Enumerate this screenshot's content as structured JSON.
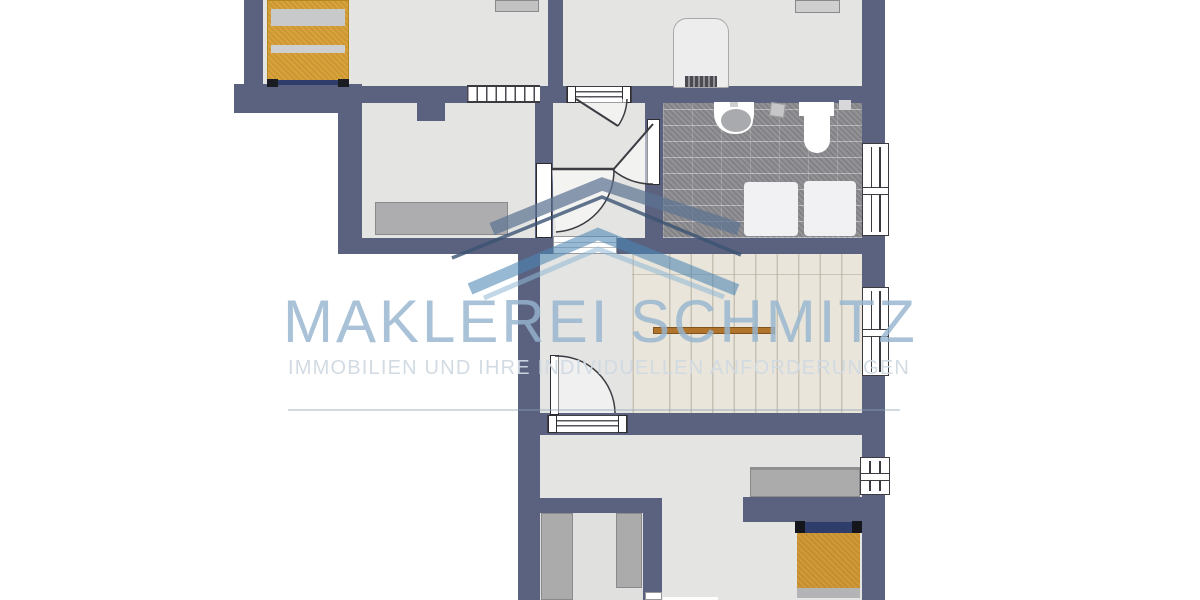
{
  "watermark": {
    "title": "MAKLEREI SCHMITZ",
    "subtitle": "IMMOBILIEN UND IHRE INDIVIDUELLEN ANFORDERUNGEN"
  },
  "palette": {
    "wall": "#5a6280",
    "floor": "#e4e4e3",
    "stair_floor": "#e9e5da",
    "tile": "#8d8d91",
    "bed_orange": "#d9a33c",
    "furniture_gray": "#ababab",
    "headboard_navy": "#2e3d69",
    "handrail_orange": "#b1742c",
    "wm_title": "rgba(150,181,208,0.82)",
    "wm_sub": "rgba(208,217,226,0.95)",
    "ribbon_slate": "#5d7392",
    "ribbon_navy": "#3b5372",
    "ribbon_steel": "#4e86b4",
    "ribbon_light": "#8fb8d6"
  }
}
